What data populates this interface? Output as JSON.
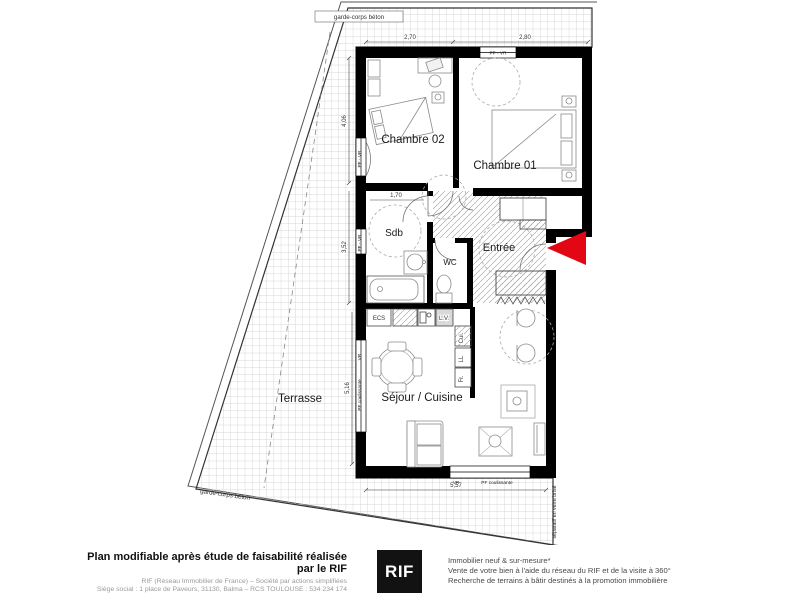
{
  "plan": {
    "rooms": {
      "chambre02": "Chambre 02",
      "chambre01": "Chambre 01",
      "sdb": "Sdb",
      "wc": "WC",
      "entree": "Entrée",
      "sejour_cuisine": "Séjour / Cuisine",
      "terrasse": "Terrasse"
    },
    "appliances": {
      "ecs": "ECS",
      "lv": "L.V.",
      "cui": "Cui.",
      "ll": "LL",
      "fr": "Fr."
    },
    "windows": {
      "pf_vr": "PF - VR",
      "vr": "VR",
      "pf_coulissante": "PF coulissante"
    },
    "dimensions": {
      "top_left": "2,70",
      "top_right": "2,80",
      "left_upper": "4,06",
      "left_middle": "3,52",
      "left_lower": "5,16",
      "sdb_width": "1,70",
      "bottom_width": "5,57"
    },
    "annotations": {
      "garde_corps_top": "garde-corps béton",
      "garde_corps_bottom": "garde-corps béton",
      "separatif": "séparatif en verre brisé"
    },
    "colors": {
      "arrow_red": "#e30613",
      "wall_black": "#000000",
      "grid_gray": "#c9c9c9"
    }
  },
  "footer": {
    "left": {
      "line1": "Plan modifiable après étude de faisabilité réalisée par le RIF",
      "line2": "RIF (Réseau Immobilier de France) – Société par actions simplifiées",
      "line3": "Siège social : 1 place de Paveurs, 31130, Balma – RCS TOULOUSE : 534 234 174"
    },
    "logo": "RIF",
    "right": {
      "line1": "Immobilier neuf & sur-mesure*",
      "line2": "Vente de votre bien à l'aide du réseau du RIF et de la visite à 360°",
      "line3": "Recherche de terrains à bâtir destinés à la promotion immobilière"
    }
  }
}
